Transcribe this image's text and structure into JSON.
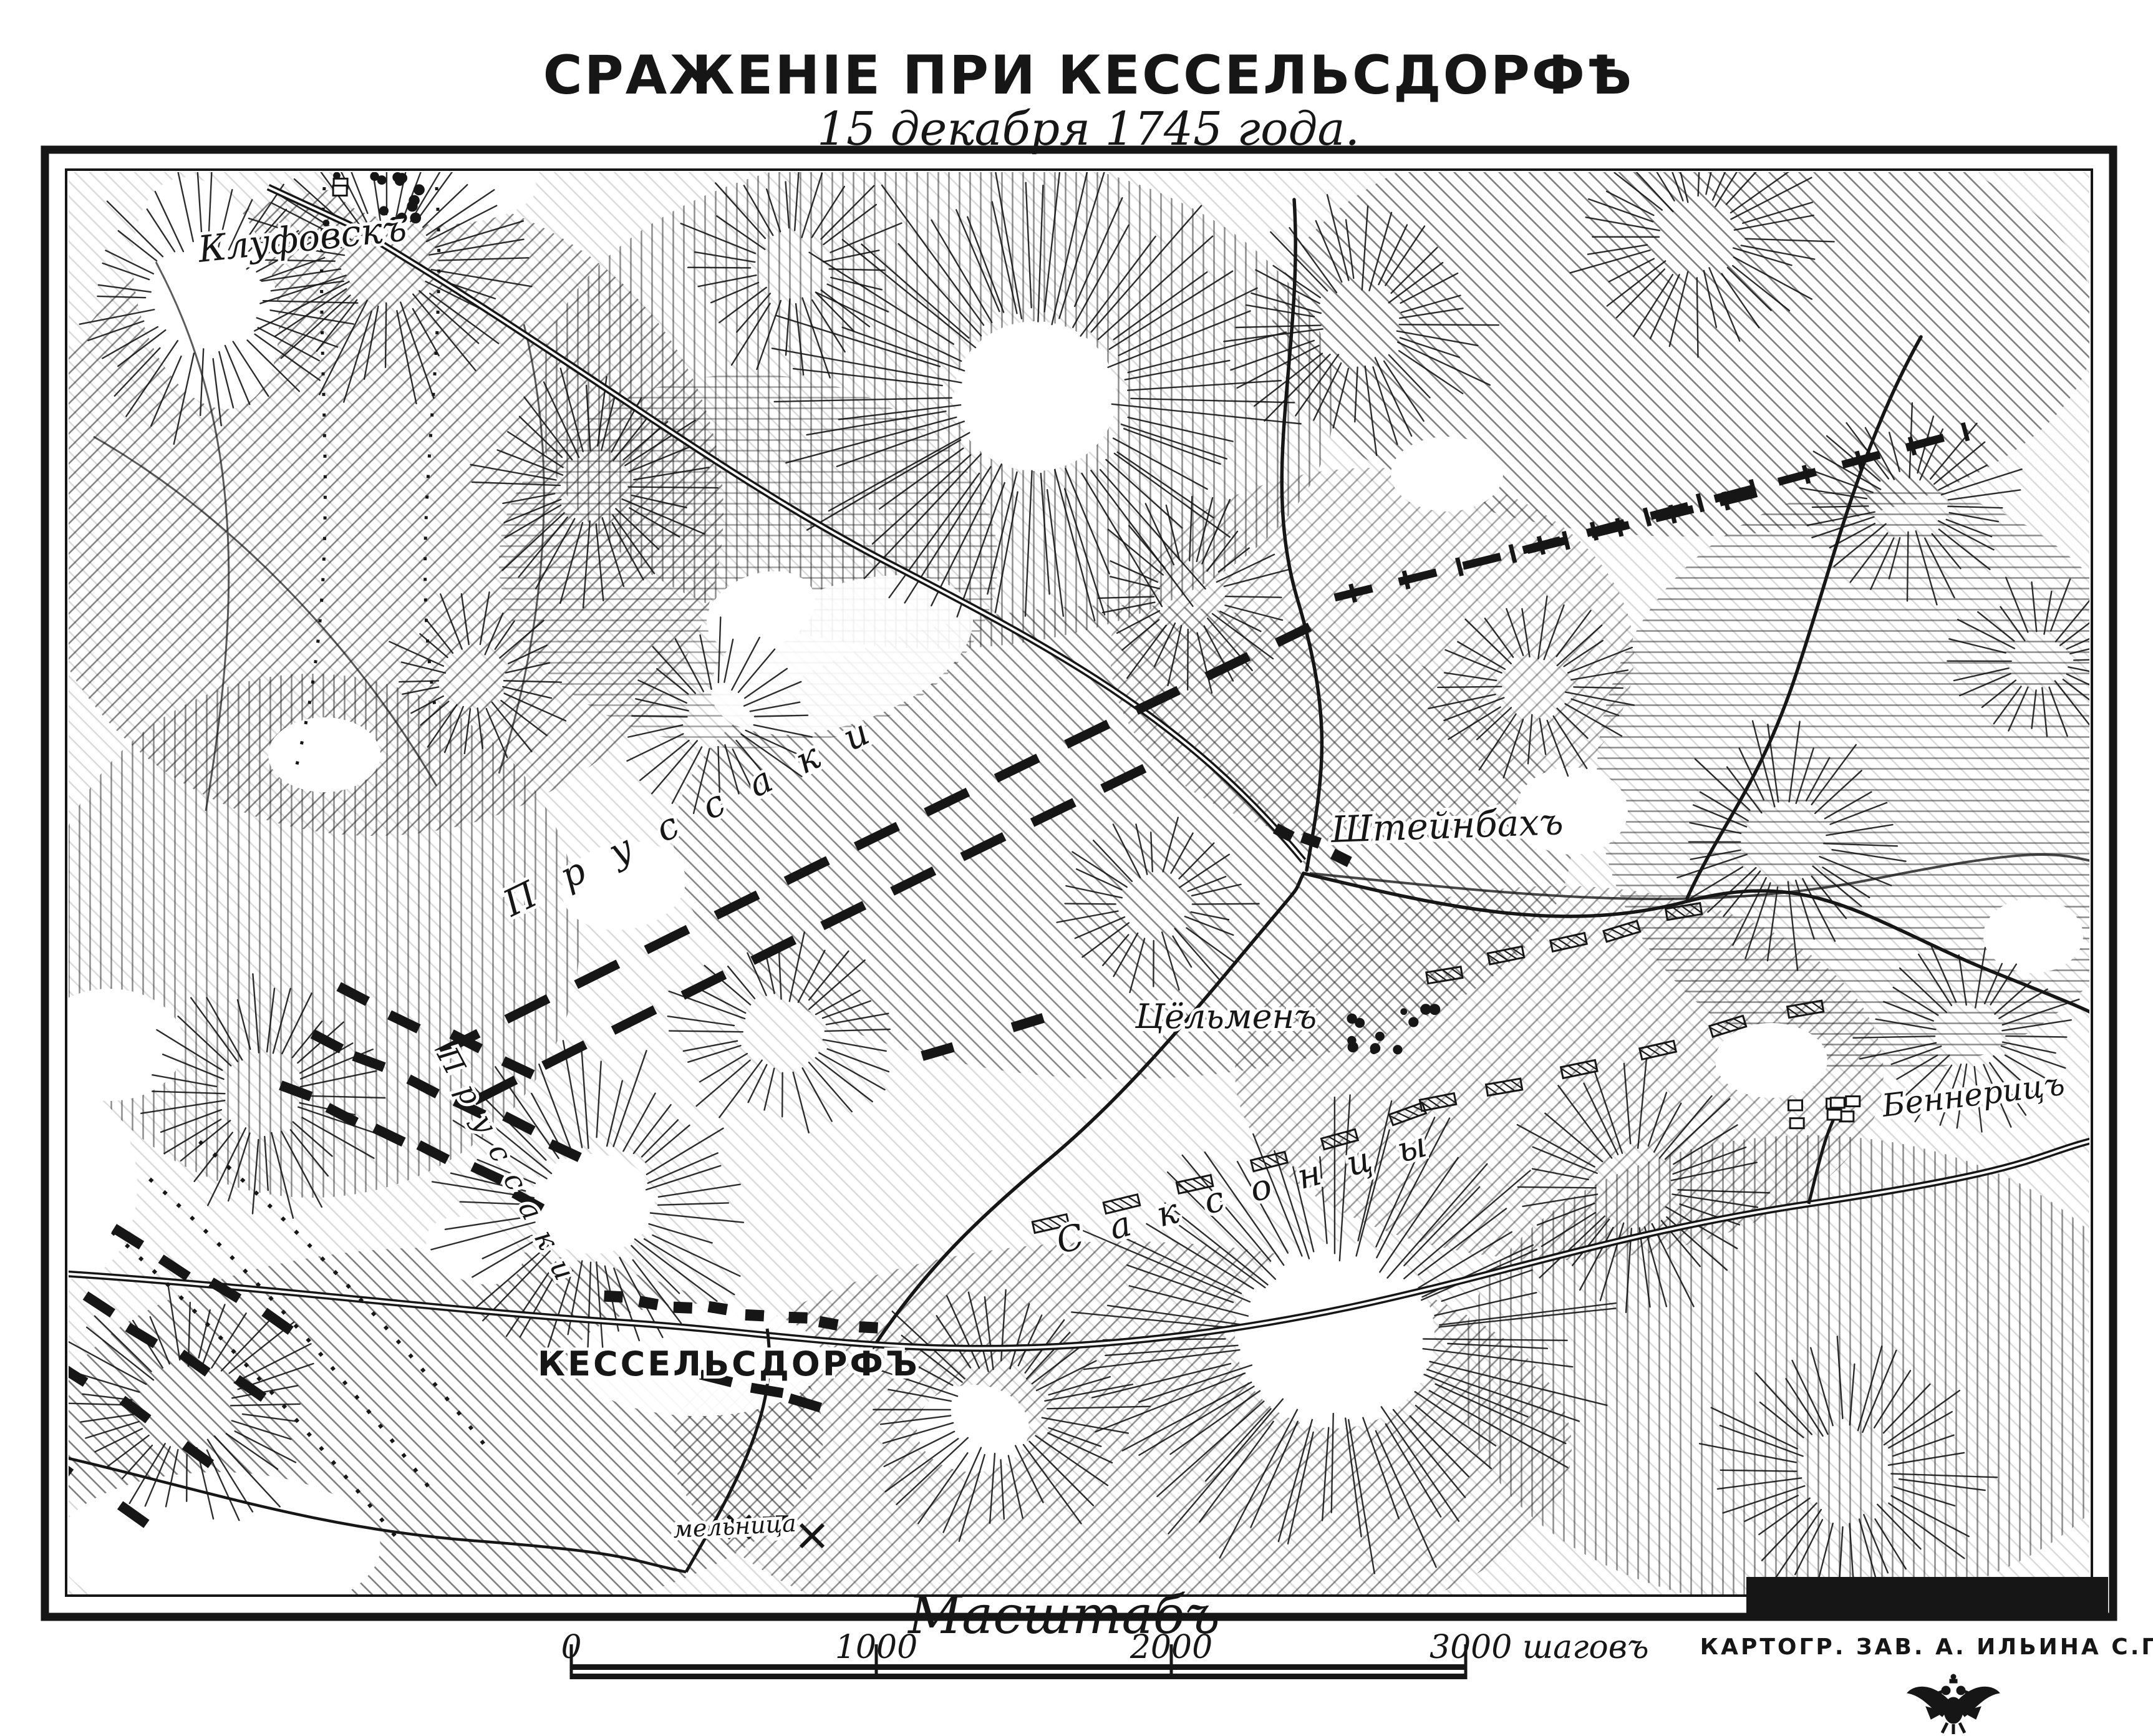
{
  "page": {
    "title": "СРАЖЕНІЕ ПРИ КЕССЕЛЬСДОРФѢ",
    "subtitle": "15 декабря 1745 года."
  },
  "map_labels": {
    "klufovsk": "Клуфовскъ",
    "prussians_advance": "Пруссаки",
    "prussians_left_wing": "Пруссаки",
    "steinbach": "Штейнбахъ",
    "zollmen": "Цёльменъ",
    "bennerits": "Беннерицъ",
    "kesselsdorf": "КЕССЕЛЬСДОРФЪ",
    "saxons": "Саксонцы",
    "mill": "мельница"
  },
  "scale_bar": {
    "title": "Масштабъ",
    "ticks": [
      "0",
      "1000",
      "2000",
      "3000 шаговъ"
    ]
  },
  "credits": {
    "engraver": "ГРАВ. Н. КОНОНОВЪ",
    "publisher": "КАРТОГР. ЗАВ. А. ИЛЬИНА С.П.Б."
  },
  "colors": {
    "ink": "#161616",
    "paper": "#ffffff"
  }
}
